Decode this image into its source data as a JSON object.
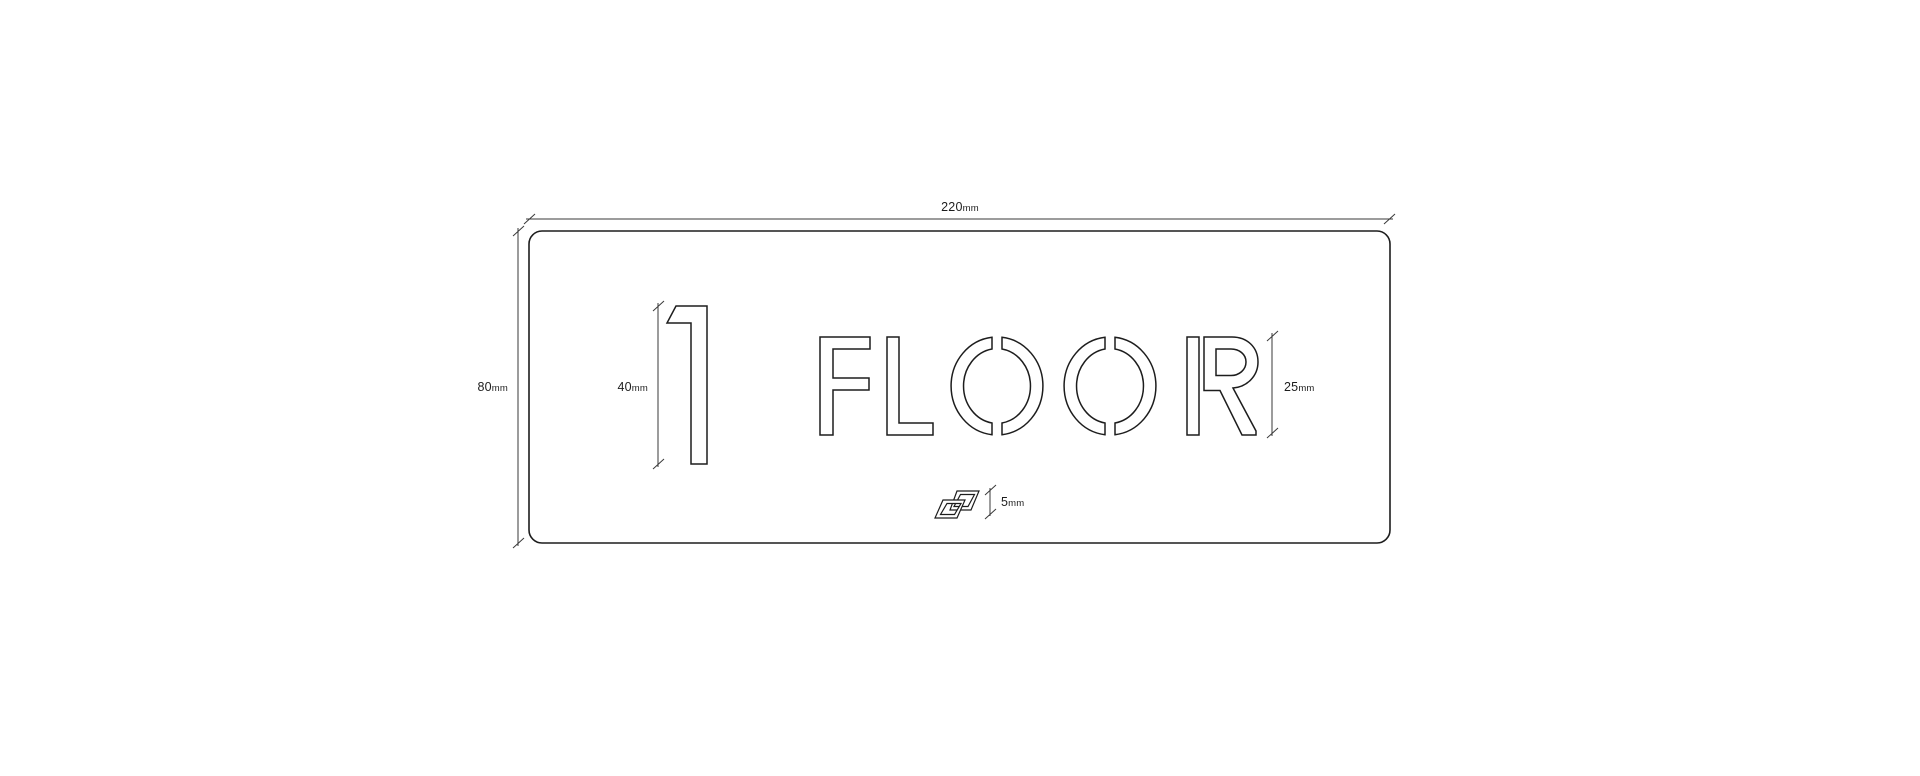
{
  "sign": {
    "number": "1",
    "word": "FLOOR",
    "full": "1 FLOOR"
  },
  "dimensions": {
    "width": {
      "value": "220",
      "unit": "mm"
    },
    "height": {
      "value": "80",
      "unit": "mm"
    },
    "number_height": {
      "value": "40",
      "unit": "mm"
    },
    "letter_height": {
      "value": "25",
      "unit": "mm"
    },
    "logo_height": {
      "value": "5",
      "unit": "mm"
    }
  },
  "icons": {
    "logo": "interlocked-parallelograms-logo"
  },
  "colors": {
    "background": "#ffffff",
    "line": "#1d1d1d",
    "dimension_line": "#3a3a3a"
  }
}
